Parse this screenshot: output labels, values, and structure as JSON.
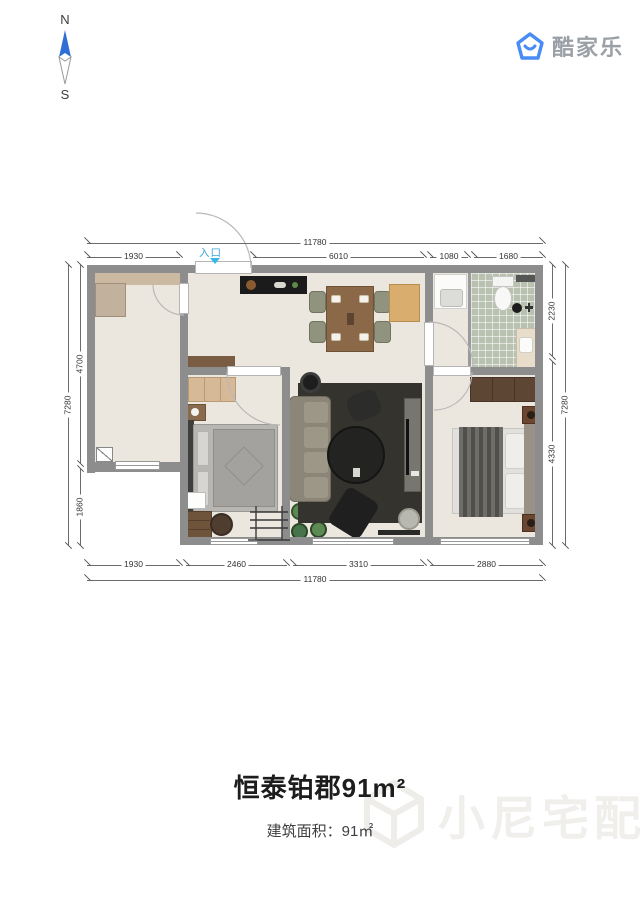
{
  "compass": {
    "north_label": "N",
    "south_label": "S",
    "needle_color": "#2f6fd6"
  },
  "logo": {
    "text": "酷家乐",
    "brand_color": "#4a8cf5"
  },
  "floorplan": {
    "entrance_label": "入口",
    "entrance_color": "#35b7e8",
    "dimensions": {
      "top_total": "11780",
      "top_segments": [
        "1930",
        "6010",
        "1080",
        "1680"
      ],
      "bottom_segments": [
        "1930",
        "2460",
        "3310",
        "2880"
      ],
      "bottom_total": "11780",
      "left_total": "7280",
      "left_segments": [
        "4700",
        "1860"
      ],
      "right_segments": [
        "2230",
        "4330"
      ],
      "right_total": "7280"
    }
  },
  "footer": {
    "title": "恒泰铂郡91m²",
    "area_label": "建筑面积：91㎡"
  },
  "watermark": {
    "text": "小尼宅配"
  }
}
